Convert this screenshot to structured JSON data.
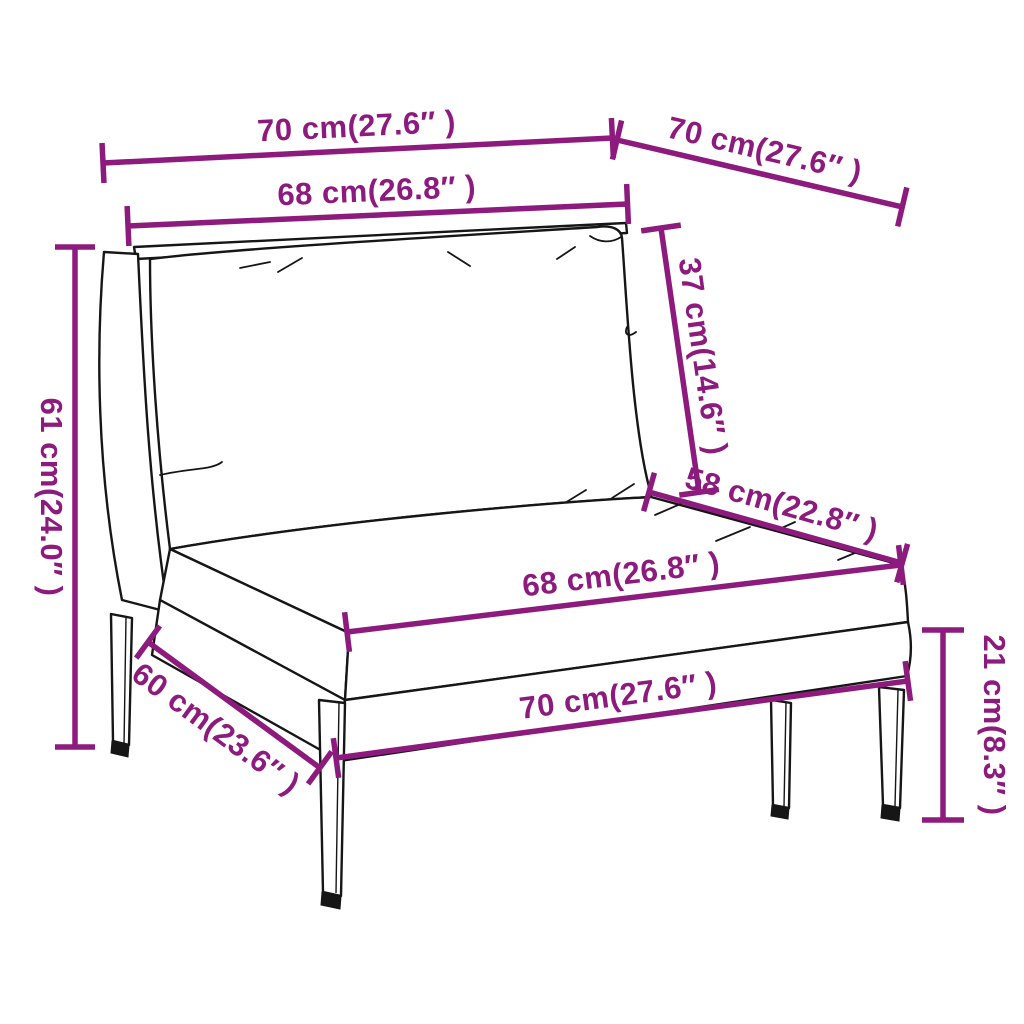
{
  "figure": {
    "description": "Line-drawing dimension diagram of a poly rattan garden sofa middle section with back and seat cushions",
    "units": "cm / inches"
  },
  "colors": {
    "dimension": "#8d1b7d",
    "outline": "#161616",
    "background": "#ffffff"
  },
  "dimensions": [
    {
      "id": "top-width",
      "label": "70 cm(27.6″ )"
    },
    {
      "id": "top-depth",
      "label": "70 cm(27.6″ )"
    },
    {
      "id": "back-width",
      "label": "68 cm(26.8″ )"
    },
    {
      "id": "back-height",
      "label": "37 cm(14.6″ )"
    },
    {
      "id": "seat-depth",
      "label": "58 cm(22.8″ )"
    },
    {
      "id": "seat-width",
      "label": "68 cm(26.8″ )"
    },
    {
      "id": "overall-height",
      "label": "61 cm(24.0″ )"
    },
    {
      "id": "side-depth",
      "label": "60 cm(23.6″ )"
    },
    {
      "id": "bottom-width",
      "label": "70 cm(27.6″ )"
    },
    {
      "id": "base-height",
      "label": "21 cm(8.3″ )"
    }
  ]
}
